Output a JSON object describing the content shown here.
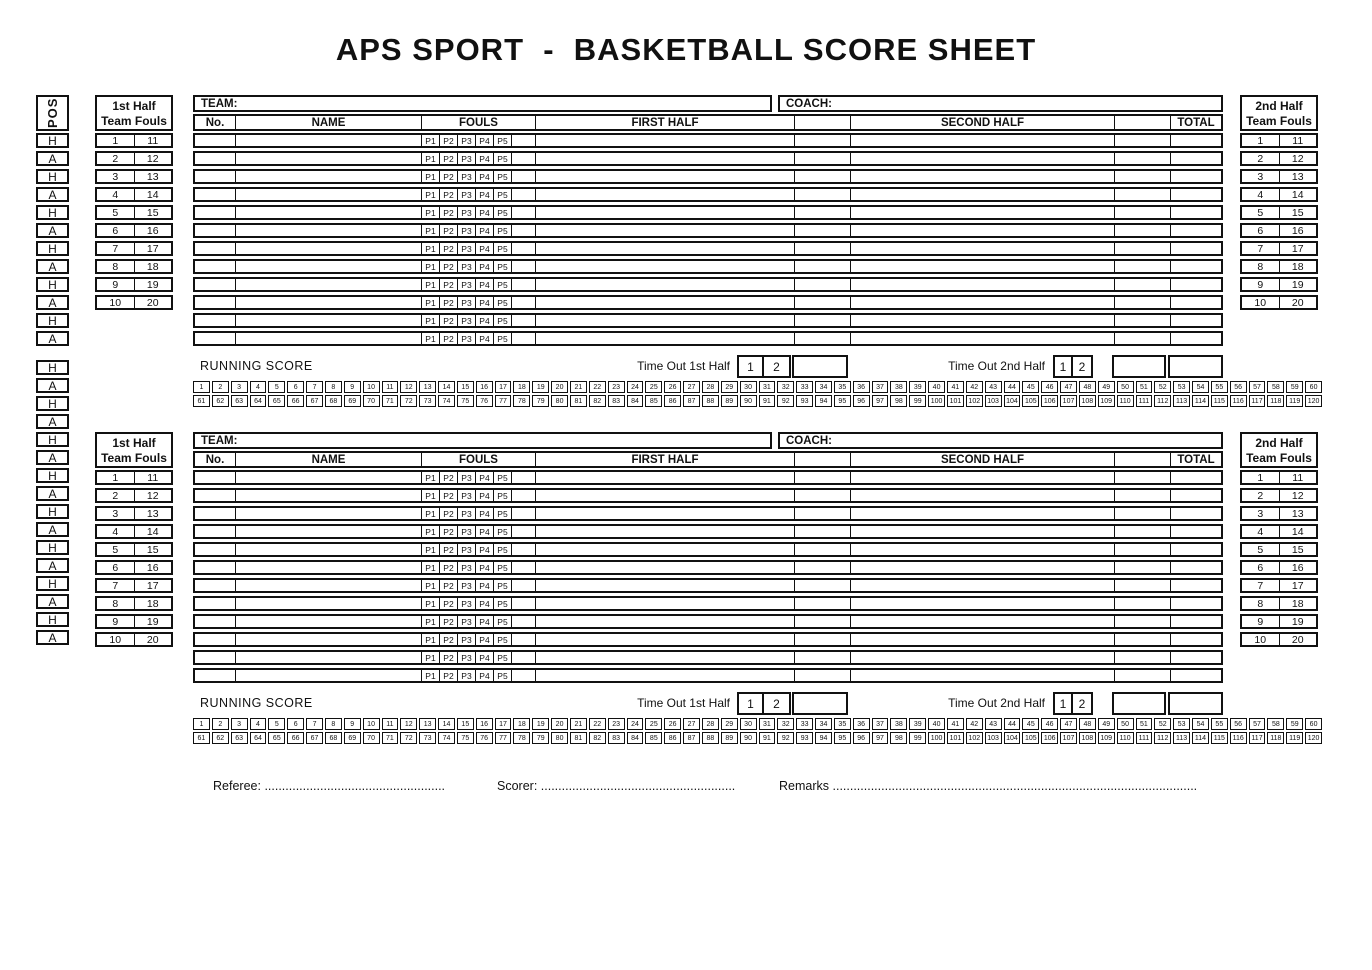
{
  "title": "APS SPORT  -  BASKETBALL SCORE SHEET",
  "colors": {
    "ink": "#111111",
    "paper": "#ffffff"
  },
  "pos": {
    "header": "POS",
    "top_cells": [
      "H",
      "A",
      "H",
      "A",
      "H",
      "A",
      "H",
      "A",
      "H",
      "A",
      "H",
      "A"
    ],
    "bottom_cells": [
      "H",
      "A",
      "H",
      "A",
      "H",
      "A",
      "H",
      "A",
      "H",
      "A",
      "H",
      "A",
      "H",
      "A",
      "H",
      "A"
    ]
  },
  "fouls_panels": {
    "first_half_title": [
      "1st Half",
      "Team Fouls"
    ],
    "second_half_title": [
      "2nd Half",
      "Team Fouls"
    ],
    "rows": [
      [
        "1",
        "11"
      ],
      [
        "2",
        "12"
      ],
      [
        "3",
        "13"
      ],
      [
        "4",
        "14"
      ],
      [
        "5",
        "15"
      ],
      [
        "6",
        "16"
      ],
      [
        "7",
        "17"
      ],
      [
        "8",
        "18"
      ],
      [
        "9",
        "19"
      ],
      [
        "10",
        "20"
      ]
    ]
  },
  "table": {
    "team_label": "TEAM:",
    "coach_label": "COACH:",
    "col_no": "No.",
    "col_name": "NAME",
    "col_fouls": "FOULS",
    "col_first_half": "FIRST HALF",
    "col_second_half": "SECOND HALF",
    "col_total": "TOTAL",
    "periods": [
      "P1",
      "P2",
      "P3",
      "P4",
      "P5"
    ],
    "rows_per_team": 12,
    "sections": 2
  },
  "running": {
    "label": "RUNNING SCORE",
    "timeout_first_label": "Time Out 1st Half",
    "timeout_second_label": "Time Out 2nd Half",
    "timeout_cells": [
      "1",
      "2"
    ],
    "row1": [
      1,
      2,
      3,
      4,
      5,
      6,
      7,
      8,
      9,
      10,
      11,
      12,
      13,
      14,
      15,
      16,
      17,
      18,
      19,
      20,
      21,
      22,
      23,
      24,
      25,
      26,
      27,
      28,
      29,
      30,
      31,
      32,
      33,
      34,
      35,
      36,
      37,
      38,
      39,
      40,
      41,
      42,
      43,
      44,
      45,
      46,
      47,
      48,
      49,
      50,
      51,
      52,
      53,
      54,
      55,
      56,
      57,
      58,
      59,
      60
    ],
    "row2": [
      61,
      62,
      63,
      64,
      65,
      66,
      67,
      68,
      69,
      70,
      71,
      72,
      73,
      74,
      75,
      76,
      77,
      78,
      79,
      80,
      81,
      82,
      83,
      84,
      85,
      86,
      87,
      88,
      89,
      90,
      91,
      92,
      93,
      94,
      95,
      96,
      97,
      98,
      99,
      100,
      101,
      102,
      103,
      104,
      105,
      106,
      107,
      108,
      109,
      110,
      111,
      112,
      113,
      114,
      115,
      116,
      117,
      118,
      119,
      120
    ]
  },
  "footer": {
    "referee": "Referee:",
    "referee_dots": "....................................................",
    "scorer": "Scorer:",
    "scorer_dots": "........................................................",
    "remarks": "Remarks",
    "remarks_dots": "........................................................................................................."
  }
}
